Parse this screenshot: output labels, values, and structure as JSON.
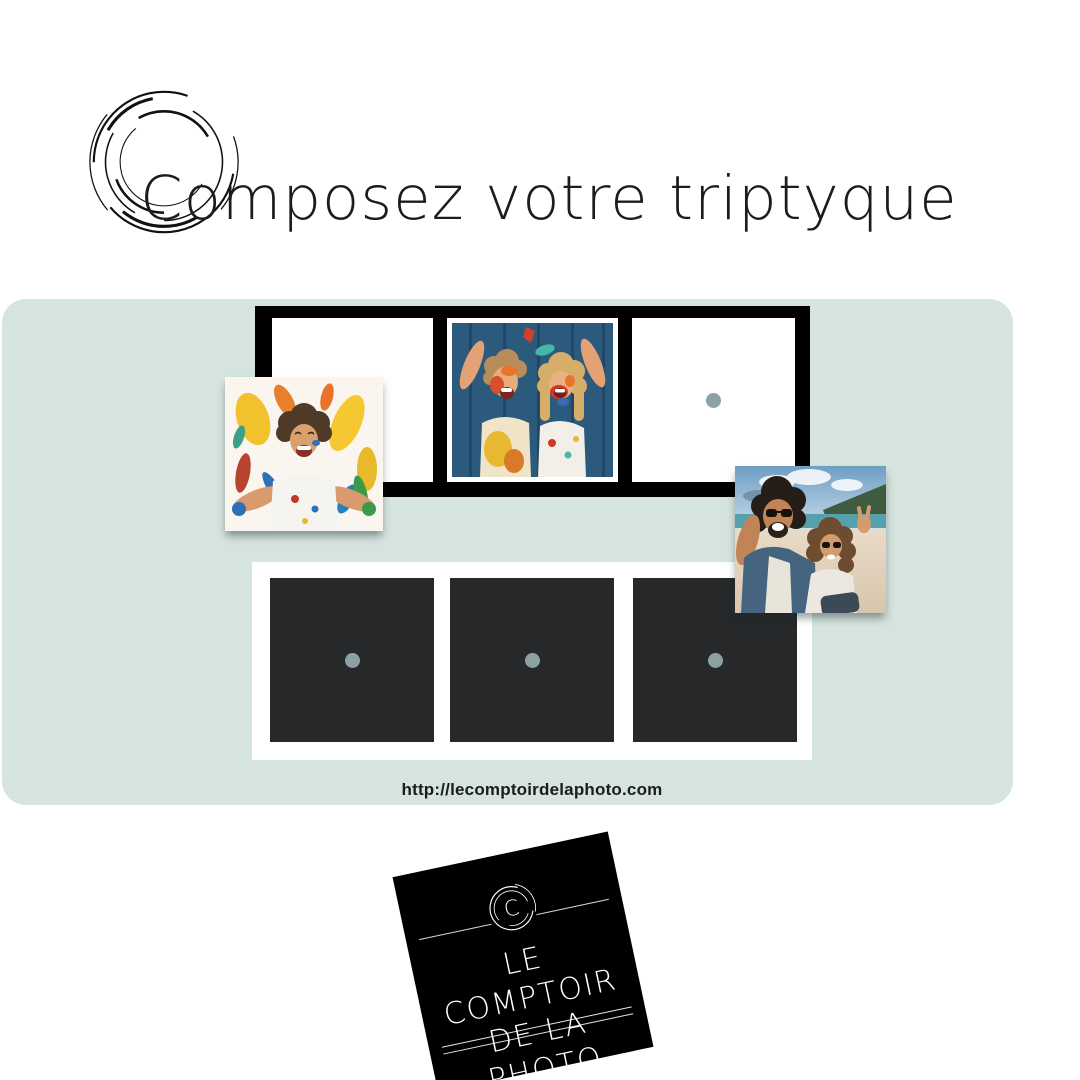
{
  "title": {
    "text": "Composez votre triptyque"
  },
  "colors": {
    "mint": "#d5e4de",
    "frame-black": "#000000",
    "slot-white": "#ffffff",
    "square-dark": "#26282a",
    "dot-gray": "#8ba1a3",
    "text-dark": "#1c1c1c",
    "logo-bg": "#000000",
    "logo-text": "#ffffff"
  },
  "triptych_top": {
    "slots": [
      {
        "id": 1,
        "state": "empty"
      },
      {
        "id": 2,
        "state": "filled",
        "content": "kids-painted-faces-photo"
      },
      {
        "id": 3,
        "state": "empty-with-dot"
      }
    ]
  },
  "triptych_bottom": {
    "slots": [
      {
        "id": 1,
        "state": "empty-with-dot"
      },
      {
        "id": 2,
        "state": "empty-with-dot"
      },
      {
        "id": 3,
        "state": "empty-with-dot"
      }
    ]
  },
  "photos": {
    "toddler": "toddler-paint-splatter-photo",
    "kids": "kids-painted-faces-photo",
    "couple": "couple-beach-selfie-photo"
  },
  "footer": {
    "url": "http://lecomptoirdelaphoto.com"
  },
  "logo": {
    "monogram": "C",
    "line1": "LE COMPTOIR",
    "line2": "DE LA PHOTO"
  }
}
